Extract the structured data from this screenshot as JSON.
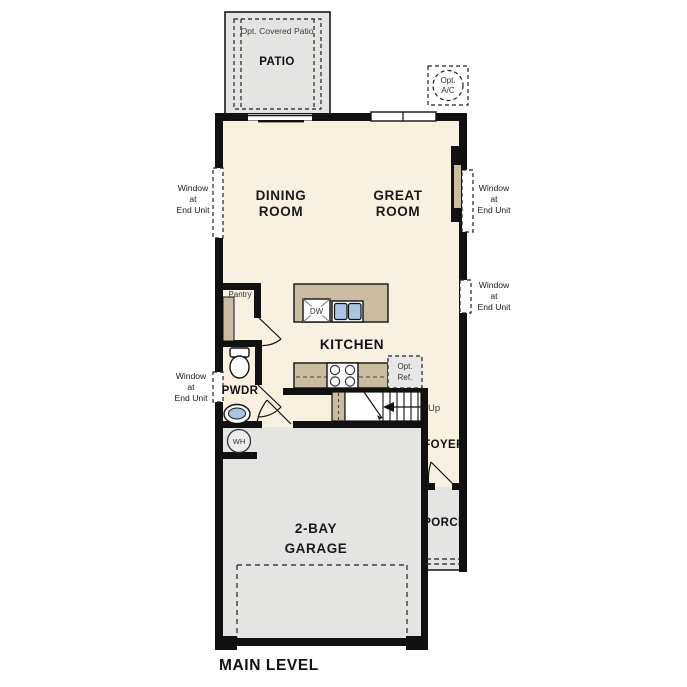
{
  "plan": {
    "title": "MAIN LEVEL",
    "rooms": {
      "patio": {
        "opt_label": "Opt. Covered Patio",
        "label": "PATIO"
      },
      "dining": {
        "line1": "DINING",
        "line2": "ROOM"
      },
      "great": {
        "line1": "GREAT",
        "line2": "ROOM"
      },
      "kitchen": {
        "label": "KITCHEN"
      },
      "pantry": {
        "label": "Pantry"
      },
      "pwdr": {
        "label": "PWDR"
      },
      "foyer": {
        "label": "FOYER"
      },
      "porch": {
        "label": "PORCH"
      },
      "garage": {
        "line1": "2-BAY",
        "line2": "GARAGE"
      }
    },
    "annotations": {
      "window_note": {
        "line1": "Window",
        "line2": "at",
        "line3": "End Unit"
      },
      "opt_ac": {
        "line1": "Opt.",
        "line2": "A/C"
      },
      "opt_ref": {
        "line1": "Opt.",
        "line2": "Ref."
      },
      "up": "Up",
      "dw": "DW",
      "wh": "WH"
    },
    "colors": {
      "interior_floor": "#f8f0e1",
      "concrete": "#e4e4e2",
      "counter": "#c9bca1",
      "sink_blue": "#a9c5e3",
      "wall": "#111111"
    }
  }
}
